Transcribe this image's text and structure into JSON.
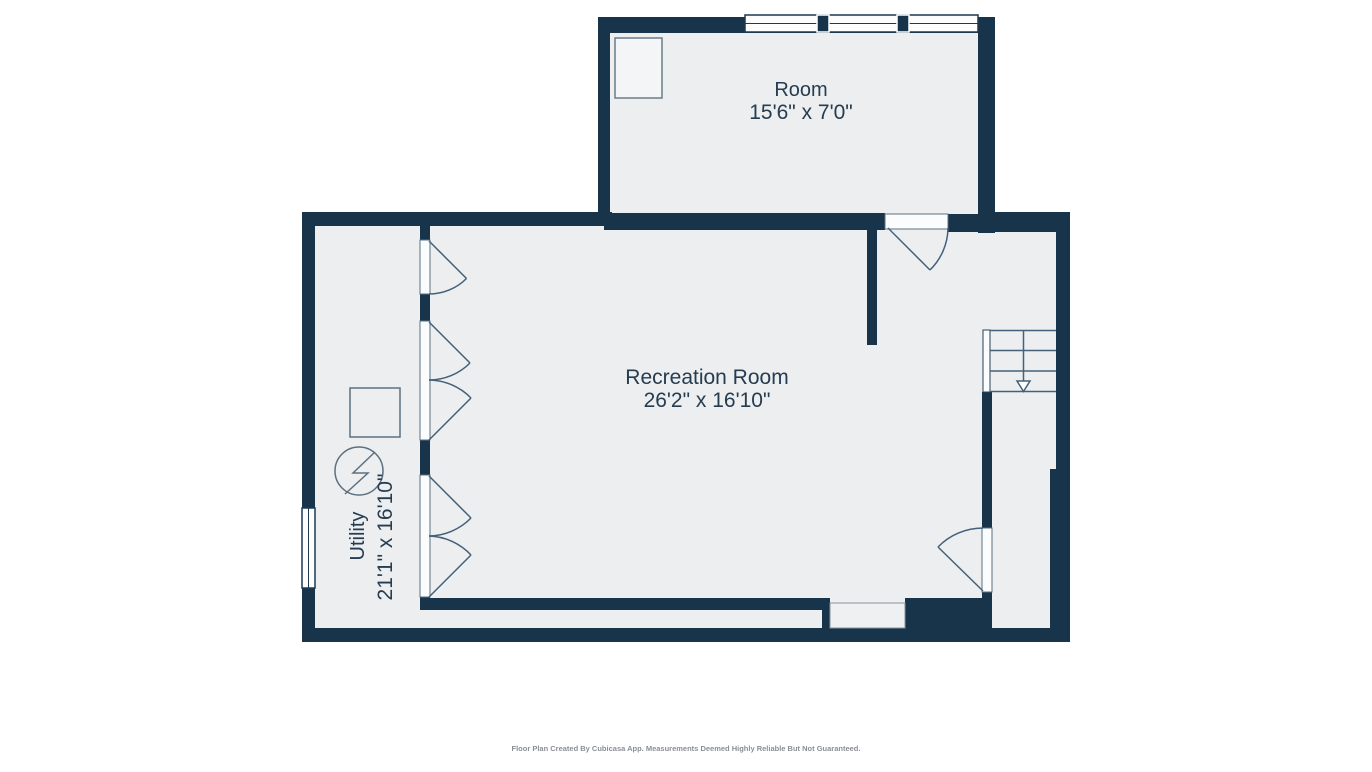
{
  "plan": {
    "rooms": [
      {
        "name": "Room",
        "dimensions": "15'6\" x 7'0\""
      },
      {
        "name": "Recreation Room",
        "dimensions": "26'2\" x 16'10\""
      },
      {
        "name": "Utility",
        "dimensions": "21'1\" x 16'10\""
      }
    ],
    "footer": "Floor Plan Created By Cubicasa App. Measurements Deemed Highly Reliable But Not Guaranteed.",
    "symbols": {
      "stairs": "staircase-with-down-arrow",
      "utility_equipment": "circle-zigzag-symbol",
      "utility_fixture": "square-outline",
      "windows": [
        "triple-window-top-wall",
        "single-window-left-wall"
      ],
      "door_leaves": 7
    },
    "colors": {
      "wall": "#17344a",
      "floor": "#eceeef",
      "detail_line": "#44607a",
      "fixture_line": "#5d7081",
      "label_text": "#263c50",
      "footer_text": "#8a8f96",
      "background": "#ffffff"
    }
  }
}
